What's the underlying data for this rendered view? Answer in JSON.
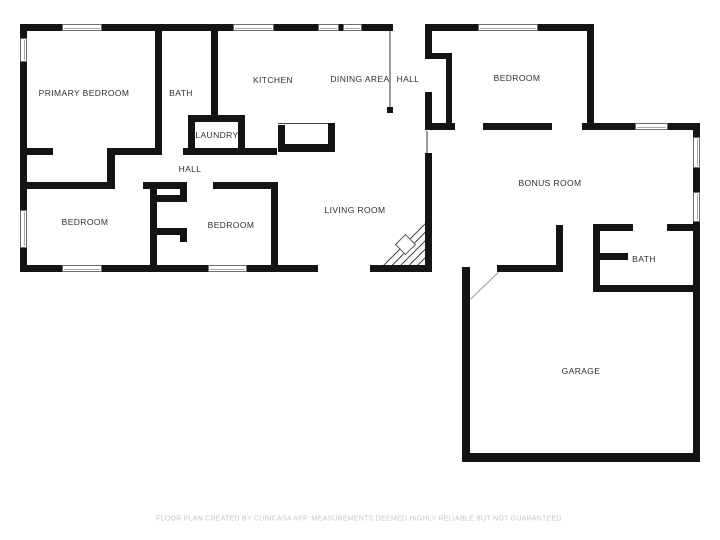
{
  "floor_plan": {
    "rooms": {
      "primary_bedroom": {
        "label": "PRIMARY BEDROOM"
      },
      "bath_main": {
        "label": "BATH"
      },
      "kitchen": {
        "label": "KITCHEN"
      },
      "dining_area": {
        "label": "DINING AREA"
      },
      "hall_top": {
        "label": "HALL"
      },
      "laundry": {
        "label": "LAUNDRY"
      },
      "hall_mid": {
        "label": "HALL"
      },
      "bedroom_left": {
        "label": "BEDROOM"
      },
      "bedroom_mid": {
        "label": "BEDROOM"
      },
      "living_room": {
        "label": "LIVING ROOM"
      },
      "bedroom_right": {
        "label": "BEDROOM"
      },
      "bonus_room": {
        "label": "BONUS ROOM"
      },
      "bath_right": {
        "label": "BATH"
      },
      "garage": {
        "label": "GARAGE"
      }
    },
    "footer": "FLOOR PLAN CREATED BY CUBICASA APP. MEASUREMENTS DEEMED HIGHLY RELIABLE BUT NOT GUARANTEED.",
    "colors": {
      "wall": "#141414",
      "label": "#2f2f2f",
      "thin_line": "#9a9a9a",
      "footer": "#c7c7c7"
    }
  }
}
